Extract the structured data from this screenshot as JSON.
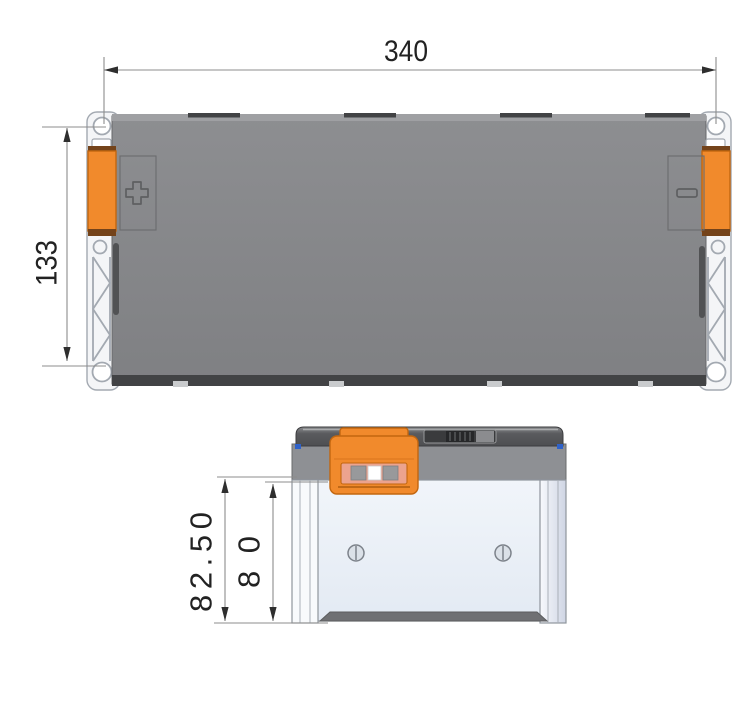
{
  "drawing_title": "battery-cell-dimension-drawing",
  "front_view": {
    "dim_width": "340",
    "dim_height": "133"
  },
  "side_view": {
    "dim_overall_height": "82.50",
    "dim_inner_height": "80"
  },
  "icons": {
    "positive_symbol": "+",
    "negative_symbol": "−"
  },
  "colors": {
    "bg": "#ffffff",
    "line": "#8c8c8c",
    "arrow": "#2e2e2e",
    "text": "#222222",
    "body_gray1": "#8d8e91",
    "body_gray2": "#7f8083",
    "edge_dark": "#424345",
    "strip_light": "#9fa0a3",
    "notch_light": "#c9cbcd",
    "cap_white": "#f4f5f7",
    "cap_stroke": "#a3a9b1",
    "orange": "#f18a2c",
    "orange_dark": "#c2660f",
    "crimp_brown": "#74431a",
    "salmon": "#eca38e",
    "symbol_gray": "#5e5f61",
    "side_cap1": "#8a8b8e",
    "side_cap2": "#4e4f52",
    "band_gray": "#8e9094",
    "slot_dark": "#3a3b3d",
    "side_body1": "#f1f5fa",
    "side_body2": "#e3eaf3",
    "column_lav": "#cfd5e4",
    "side_stroke": "#8f959d",
    "groove_gray": "#6f7073",
    "screw_fill": "#dbe1e8",
    "screw_stroke": "#7c828a",
    "blue_mark": "#2f62c9"
  }
}
